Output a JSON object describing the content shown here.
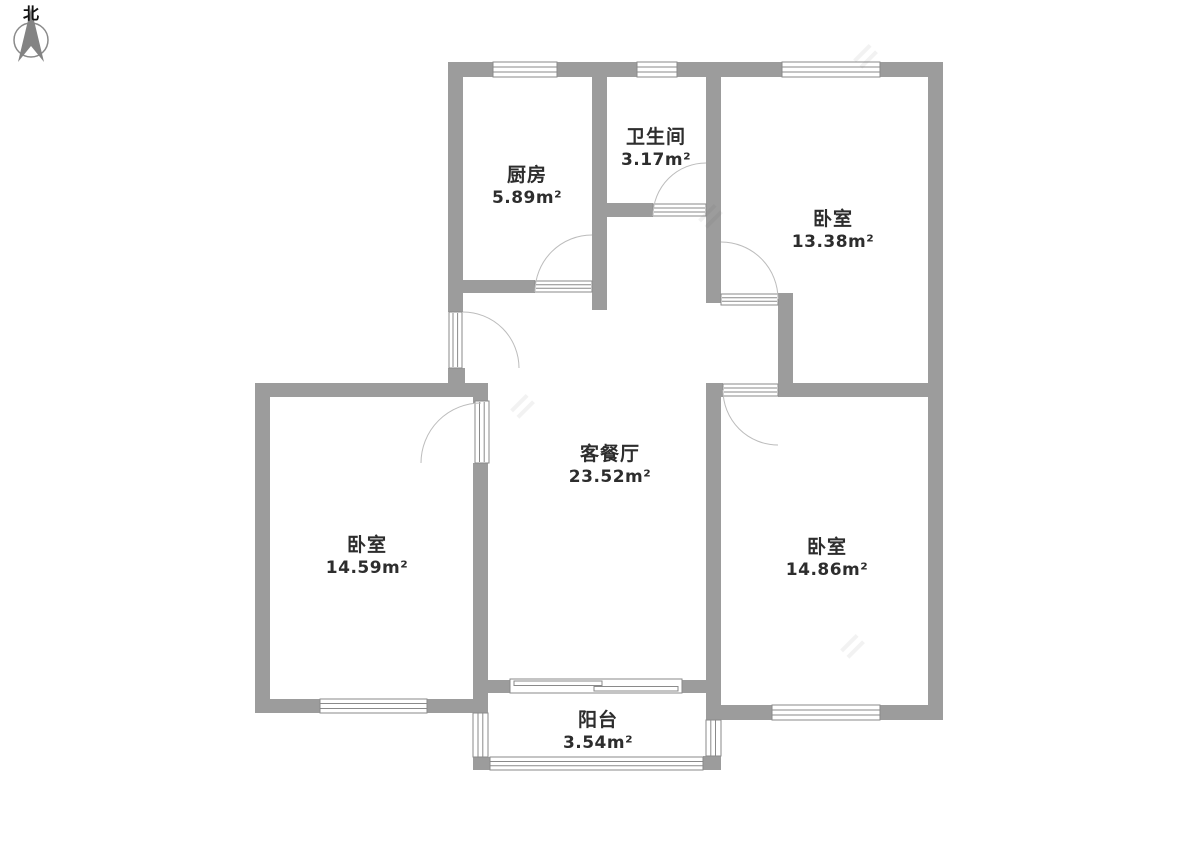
{
  "page": {
    "background": "#ffffff",
    "type": "residential floor plan"
  },
  "compass": {
    "label": "北"
  },
  "rooms": [
    {
      "id": "kitchen",
      "name": "厨房",
      "area": "5.89m²"
    },
    {
      "id": "bathroom",
      "name": "卫生间",
      "area": "3.17m²"
    },
    {
      "id": "bedroom-top-right",
      "name": "卧室",
      "area": "13.38m²"
    },
    {
      "id": "living-dining",
      "name": "客餐厅",
      "area": "23.52m²"
    },
    {
      "id": "bedroom-left",
      "name": "卧室",
      "area": "14.59m²"
    },
    {
      "id": "bedroom-right",
      "name": "卧室",
      "area": "14.86m²"
    },
    {
      "id": "balcony",
      "name": "阳台",
      "area": "3.54m²"
    }
  ],
  "colors": {
    "wall": "#9c9c9c",
    "opening_frame": "#8a8a8a",
    "door_arc": "#bcbcbc",
    "label_text": "#2d2d2d",
    "compass_needle": "#838383"
  }
}
